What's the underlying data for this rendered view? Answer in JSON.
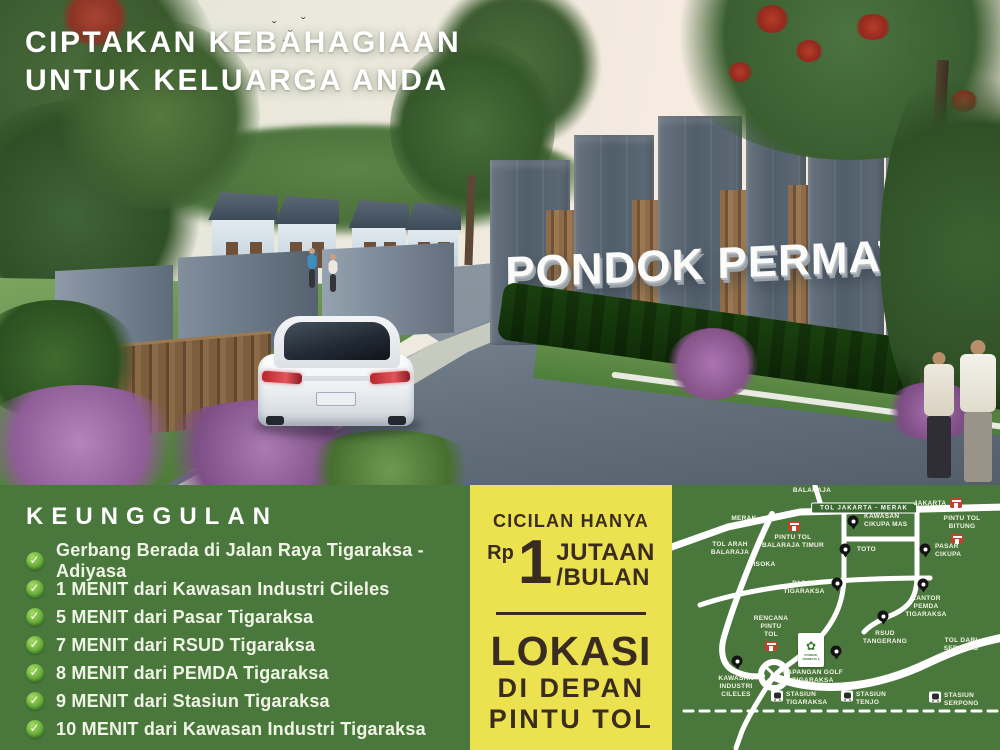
{
  "hero": {
    "headline_line1": "CIPTAKAN KEBAHAGIAAN",
    "headline_line2": "UNTUK KELUARGA ANDA",
    "sign_text": "PONDOK PERMATA 6"
  },
  "features": {
    "title": "KEUNGGULAN",
    "items": [
      "Gerbang Berada di Jalan Raya Tigaraksa - Adiyasa",
      "1 MENIT dari Kawasan Industri Cileles",
      "5 MENIT dari Pasar Tigaraksa",
      "7 MENIT dari RSUD Tigaraksa",
      "8 MENIT dari PEMDA Tigaraksa",
      "9 MENIT dari Stasiun Tigaraksa",
      "10 MENIT dari Kawasan Industri Tigaraksa"
    ]
  },
  "price_panel": {
    "line1": "CICILAN HANYA",
    "currency": "Rp",
    "amount": "1",
    "unit_line1": "JUTAAN",
    "unit_line2": "/BULAN",
    "location_line1": "LOKASI",
    "location_line2": "DI DEPAN",
    "location_line3": "PINTU TOL"
  },
  "map": {
    "toll_badge": "TOL JAKARTA - MERAK",
    "logo_label": "PONDOK PERMATA 6",
    "labels": [
      {
        "name": "balaraja",
        "text": "BALARAJA",
        "x": 140,
        "y": 2,
        "align": "center"
      },
      {
        "name": "jakarta",
        "text": "JAKARTA",
        "x": 258,
        "y": 15,
        "align": "center"
      },
      {
        "name": "merak",
        "text": "MERAK",
        "x": 72,
        "y": 30,
        "align": "center"
      },
      {
        "name": "pintu-tol-balaraja-timur",
        "text": "PINTU TOL\nBALARAJA TIMUR",
        "x": 121,
        "y": 49,
        "align": "center"
      },
      {
        "name": "kawasan-cikupa-mas",
        "text": "KAWASAN\nCIKUPA MAS",
        "x": 192,
        "y": 28,
        "align": "left"
      },
      {
        "name": "pintu-tol-bitung",
        "text": "PINTU TOL\nBITUNG",
        "x": 290,
        "y": 30,
        "align": "center"
      },
      {
        "name": "pasar-cikupa",
        "text": "PASAR\nCIKUPA",
        "x": 263,
        "y": 58,
        "align": "left"
      },
      {
        "name": "tol-arah-balaraja",
        "text": "TOL ARAH\nBALARAJA",
        "x": 58,
        "y": 56,
        "align": "center"
      },
      {
        "name": "cisoka",
        "text": "CISOKA",
        "x": 90,
        "y": 76,
        "align": "center"
      },
      {
        "name": "toto",
        "text": "TOTO",
        "x": 185,
        "y": 61,
        "align": "left"
      },
      {
        "name": "pasar-tigaraksa",
        "text": "PASAR\nTIGARAKSA",
        "x": 132,
        "y": 95,
        "align": "center"
      },
      {
        "name": "kantor-pemda-tigaraksa",
        "text": "KANTOR\nPEMDA\nTIGARAKSA",
        "x": 254,
        "y": 110,
        "align": "center"
      },
      {
        "name": "rencana-pintu-tol",
        "text": "RENCANA\nPINTU\nTOL",
        "x": 99,
        "y": 130,
        "align": "center"
      },
      {
        "name": "rsud-tangerang",
        "text": "RSUD\nTANGERANG",
        "x": 213,
        "y": 145,
        "align": "center"
      },
      {
        "name": "tol-dari-serpong",
        "text": "TOL DARI\nSERPONG",
        "x": 289,
        "y": 152,
        "align": "center"
      },
      {
        "name": "lapangan-golf-tigaraksa",
        "text": "LAPANGAN GOLF\nTIGARAKSA",
        "x": 141,
        "y": 184,
        "align": "center"
      },
      {
        "name": "kawasan-industri-cileles",
        "text": "KAWASAN\nINDUSTRI\nCILELES",
        "x": 64,
        "y": 190,
        "align": "center"
      },
      {
        "name": "stasiun-tigaraksa",
        "text": "STASIUN\nTIGARAKSA",
        "x": 114,
        "y": 206,
        "align": "left"
      },
      {
        "name": "stasiun-tenjo",
        "text": "STASIUN\nTENJO",
        "x": 184,
        "y": 206,
        "align": "left"
      },
      {
        "name": "stasiun-serpong",
        "text": "STASIUN\nSERPONG",
        "x": 272,
        "y": 207,
        "align": "left"
      }
    ],
    "icons": [
      {
        "type": "toll",
        "x": 284,
        "y": 18
      },
      {
        "type": "toll",
        "x": 122,
        "y": 41
      },
      {
        "type": "toll",
        "x": 285,
        "y": 54
      },
      {
        "type": "toll",
        "x": 99,
        "y": 161
      },
      {
        "type": "pin",
        "x": 181,
        "y": 36
      },
      {
        "type": "pin",
        "x": 253,
        "y": 64
      },
      {
        "type": "pin",
        "x": 173,
        "y": 64
      },
      {
        "type": "pin",
        "x": 165,
        "y": 98
      },
      {
        "type": "pin",
        "x": 251,
        "y": 99
      },
      {
        "type": "pin",
        "x": 211,
        "y": 131
      },
      {
        "type": "pin",
        "x": 164,
        "y": 166
      },
      {
        "type": "pin",
        "x": 65,
        "y": 176
      },
      {
        "type": "train",
        "x": 105,
        "y": 211
      },
      {
        "type": "train",
        "x": 175,
        "y": 211
      },
      {
        "type": "train",
        "x": 263,
        "y": 212
      }
    ]
  },
  "colors": {
    "band_green": "#4a783c",
    "panel_yellow": "#ece24f",
    "panel_text": "#3a2c20",
    "map_road": "#ffffff",
    "toll_icon_red": "#c6402e",
    "check_green": "#6cb13c"
  }
}
